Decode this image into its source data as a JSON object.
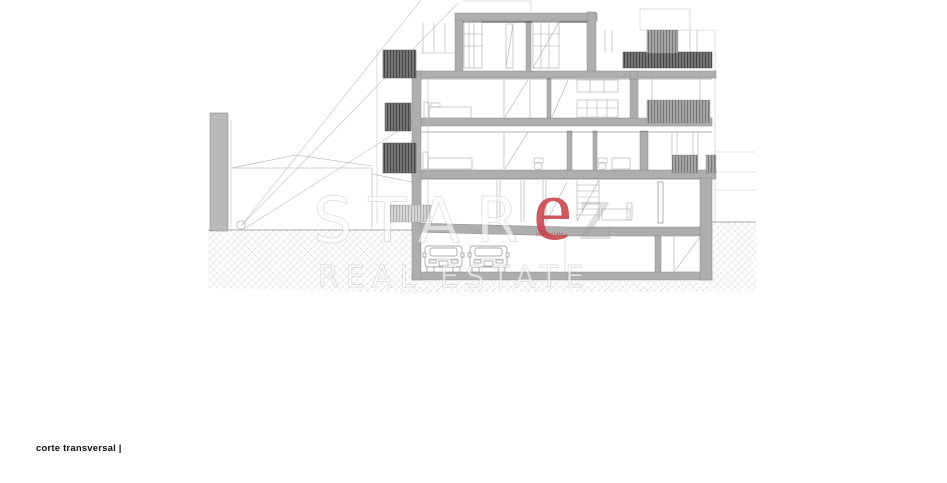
{
  "page": {
    "background": "#ffffff"
  },
  "caption": {
    "text": "corte transversal |"
  },
  "watermark": {
    "brand_prefix": "STAR",
    "brand_accent_letter": "e",
    "brand_suffix_letter": "z",
    "line2": "REAL ESTATE",
    "tagline": "real estate",
    "accent_color": "#c8414b",
    "gray_letter_color": "#9a9a9a"
  },
  "drawing": {
    "levels_count": 5,
    "cars_count": 2,
    "colors": {
      "cut_element_gray": "#aeaeae",
      "louver_dark": "#6e6e6e",
      "louver_medium": "#a7a7a7",
      "louver_light": "#d2d2d2",
      "hatch_line": "#cccccc",
      "outline": "#9a9a9a",
      "ground_line": "#8f8f8f"
    }
  }
}
